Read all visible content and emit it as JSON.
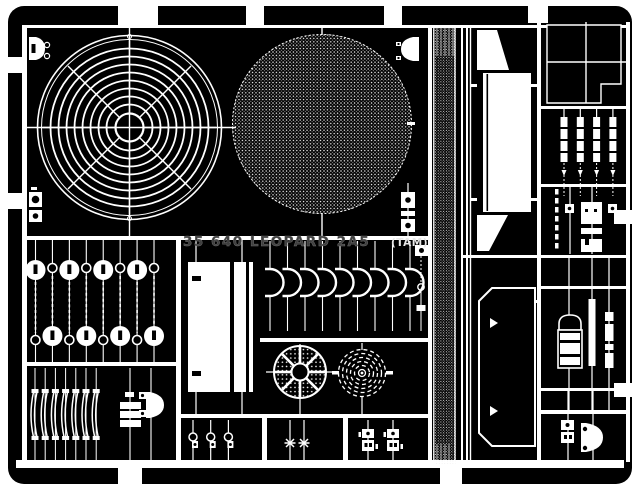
{
  "fret": {
    "title": "35 640 LEOPARD 2A5",
    "title_suffix": "(TAM)",
    "colors": {
      "page": "#ffffff",
      "film": "#000000",
      "metal": "#ffffff",
      "etched_text": "#3f3f3f"
    },
    "repeated": {
      "grille_rings": 8,
      "grille_spokes": 8,
      "tie_down_chains": 8,
      "bracket_hooks": 9,
      "hinge_strips": 4,
      "leaf_springs": 7,
      "shackles": 3,
      "turnbuckles": 2,
      "latch_pairs": 2,
      "wheel_spokes": 8,
      "coil_rings": 5
    }
  }
}
